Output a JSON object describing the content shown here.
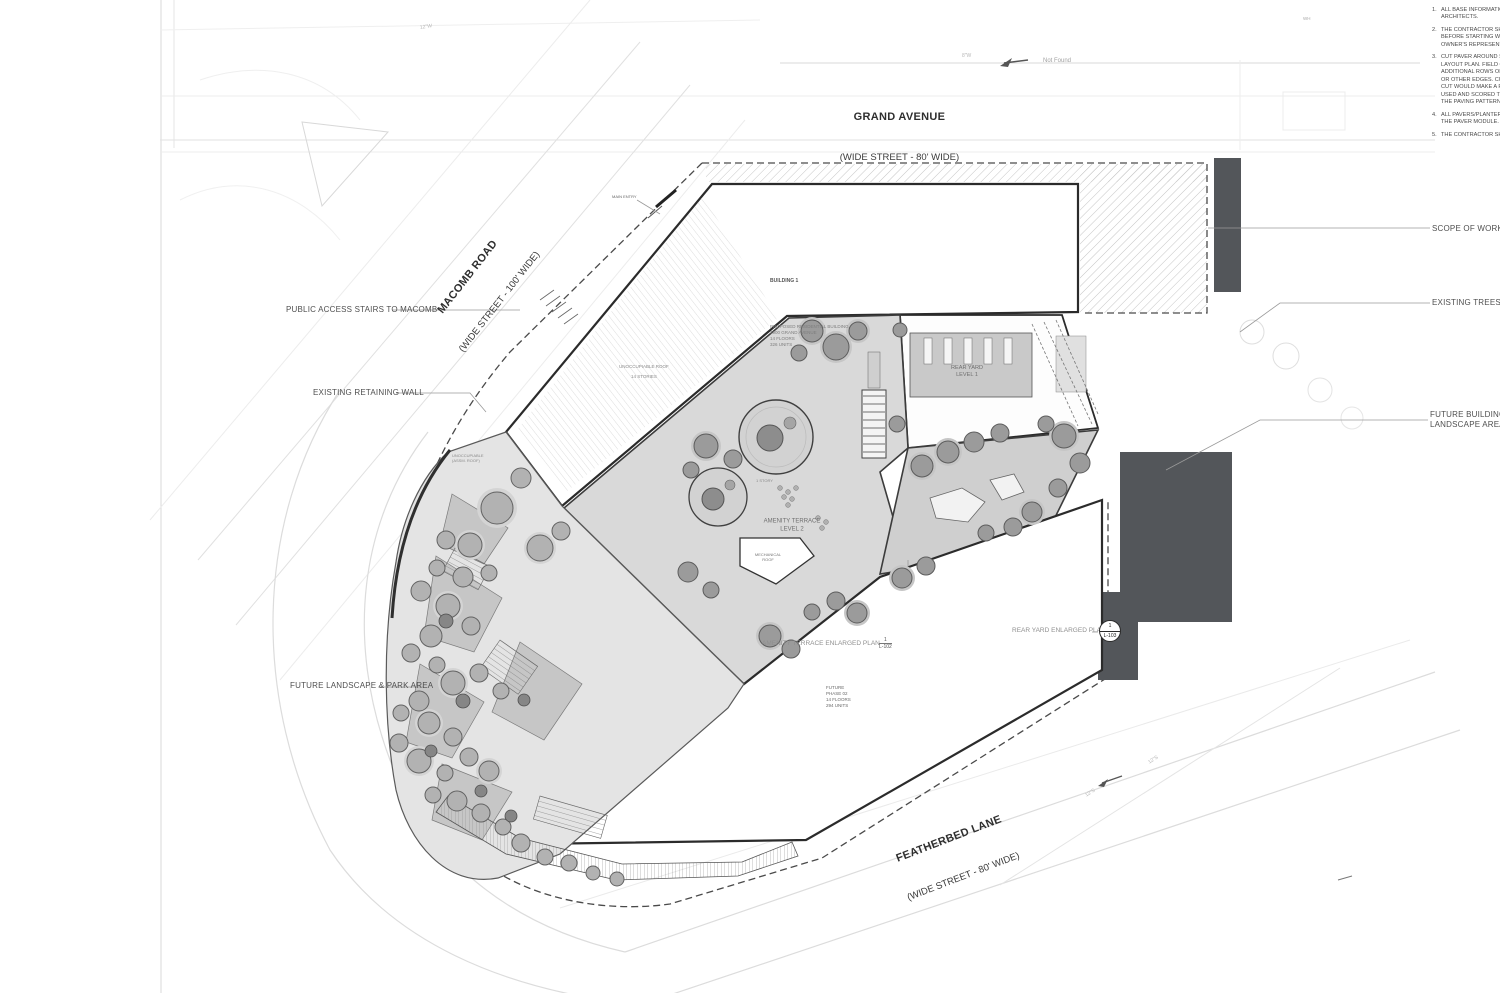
{
  "streets": {
    "grand": {
      "name": "GRAND AVENUE",
      "spec": "(WIDE STREET - 80' WIDE)"
    },
    "macomb": {
      "name": "MACOMB ROAD",
      "spec": "(WIDE STREET - 100' WIDE)"
    },
    "featherbed": {
      "name": "FEATHERBED LANE",
      "spec": "(WIDE STREET - 80' WIDE)"
    }
  },
  "notes": [
    {
      "num": "1.",
      "text": "ALL BASE INFORMATION F\nARCHITECTS."
    },
    {
      "num": "2.",
      "text": "THE CONTRACTOR SHALL\nBEFORE STARTING WORK.\nOWNER'S REPRESENTATIV"
    },
    {
      "num": "3.",
      "text": "CUT PAVER AROUND STRU\nLAYOUT PLAN. FIELD CON\nADDITIONAL ROWS OF CU\nOR OTHER EDGES. CUT PA\nCUT WOULD MAKE A PAV\nUSED AND SCORED TO CR\nTHE PAVING PATTERN."
    },
    {
      "num": "4.",
      "text": "ALL PAVERS/PLANTERS SH\nTHE PAVER MODULE."
    },
    {
      "num": "5.",
      "text": "THE CONTRACTOR SHALL"
    }
  ],
  "callouts": {
    "scope": "SCOPE OF WORK (PHASE",
    "trees": "EXISTING TREES TO REM",
    "future_building": "FUTURE BUILDING AND A\nLANDSCAPE AREA (PHAS",
    "public_stairs": "PUBLIC ACCESS STAIRS TO MACOMB",
    "retaining_wall": "EXISTING RETAINING WALL",
    "future_landscape": "FUTURE LANDSCAPE & PARK AREA"
  },
  "building1": {
    "title": "BUILDING 1",
    "details": "PROPOSED RESIDENTIAL BUILDING\n1900 GRAND AVENUE\n14 FLOORS\n326 UNITS"
  },
  "future_phase": {
    "text": "FUTURE\nPHASE 02\n14 FLOORS\n294 UNITS"
  },
  "areas": {
    "rear_yard": "REAR YARD\nLEVEL 1",
    "amenity": "AMENITY TERRACE\nLEVEL 2",
    "unoccupiable_roof": "UNOCCUPIABLE ROOF",
    "stories": "14 STORIES",
    "unoccupiable_assm": "UNOCCUPIABLE\n(ASSM. ROOF)",
    "one_story": "1 STORY",
    "mechanical": "MECHANICAL\nROOF",
    "main_entry": "MAIN ENTRY"
  },
  "refs": {
    "amenity": {
      "label": "AMENITY TERRACE ENLARGED PLAN",
      "num": "1",
      "sheet": "L-102"
    },
    "rear": {
      "label": "REAR YARD ENLARGED PLAN",
      "num": "1",
      "sheet": "L-103"
    }
  },
  "misc": {
    "not_found": "Not Found",
    "wh": "WH",
    "w12": "12\"W",
    "w8": "8\"W",
    "s12": "12\"S"
  },
  "colors": {
    "neighbor_mass": "#53565a",
    "terrace_gray": "#d9d9d9",
    "outline": "#2b2b2b"
  }
}
